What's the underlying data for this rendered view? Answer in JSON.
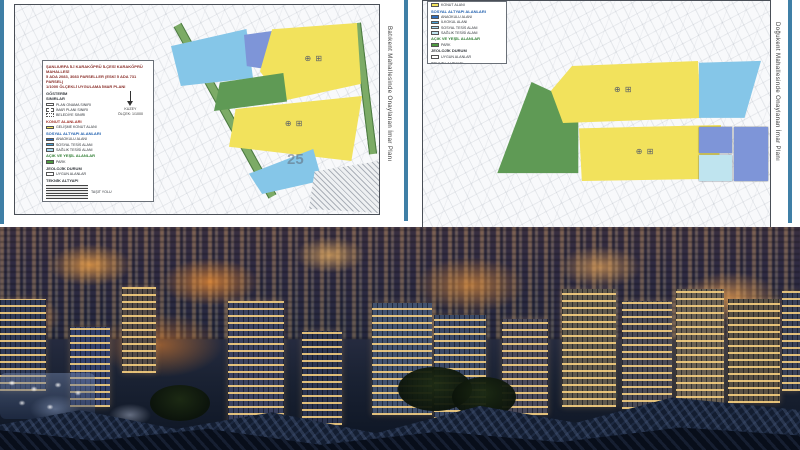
{
  "colors": {
    "accent_line": "#3f7fa6",
    "parcel_yellow": "#f2e25c",
    "parcel_blue": "#85c6e8",
    "parcel_periwinkle": "#7e95d8",
    "parcel_cyan": "#bfe4ef",
    "parcel_green": "#5f9a55",
    "photo_glow_orange": "#f7a43c"
  },
  "left_plan": {
    "caption_vertical": "Batıkent Mahallesinde Onaylanan İmar Planı",
    "watermark": "25",
    "zoning_symbols": "⊕ ⊞",
    "legend": {
      "title_lines": [
        "ŞANLIURFA İLİ KARAKÖPRÜ İLÇESİ KARAKÖPRÜ MAHALLESİ",
        "5 ADA 2083, 3083 PARSELLER (ESKİ 5 ADA 731 PARSEL)",
        "1/1000 ÖLÇEKLİ UYGULAMA İMAR PLANI"
      ],
      "gosterim_heading": "GÖSTERİM",
      "sinirlar_heading": "SINIRLAR",
      "sinir_items": [
        "PLAN ONAMA SINIRI",
        "İMAR PLANI SINIRI",
        "BELEDİYE SINIRI"
      ],
      "north_label": "KUZEY",
      "scale_label": "ÖLÇEK: 1/1000",
      "konut_heading": "KONUT ALANLARI",
      "konut_item": "GELİŞME KONUT ALANI",
      "sosyal_heading": "SOSYAL ALTYAPI ALANLARI",
      "sosyal_items": [
        "ANAOKULU ALANI",
        "SOSYAL TESİS ALANI",
        "SAĞLIK TESİSİ ALANI"
      ],
      "yesil_heading": "AÇIK VE YEŞİL ALANLAR",
      "yesil_item": "PARK",
      "jeoloji_heading": "JEOLOJİK DURUM",
      "jeoloji_item": "UYGUN ALANLAR",
      "teknik_heading": "TEKNİK ALTYAPI",
      "teknik_items": [
        "TAŞIT YOLU",
        "YAYA YOLU"
      ]
    }
  },
  "right_plan": {
    "caption_vertical": "Doğukent Mahallesinde Onaylanan İmar Planı",
    "zoning_symbols": "⊕ ⊞",
    "legend": {
      "konut_item": "KONUT ALANI",
      "sosyal_heading": "SOSYAL ALTYAPI ALANLARI",
      "sosyal_items": [
        "ANAOKULU ALANI",
        "İLKOKUL ALANI",
        "SOSYAL TESİS ALANI",
        "SAĞLIK TESİSİ ALANI"
      ],
      "yesil_heading": "AÇIK VE YEŞİL ALANLAR",
      "yesil_item": "PARK",
      "jeoloji_heading": "JEOLOJİK DURUM",
      "jeoloji_item": "UYGUN ALANLAR",
      "teknik_heading": "TEKNİK ALTYAPI",
      "teknik_items": [
        "TAŞIT YOLU"
      ]
    }
  }
}
